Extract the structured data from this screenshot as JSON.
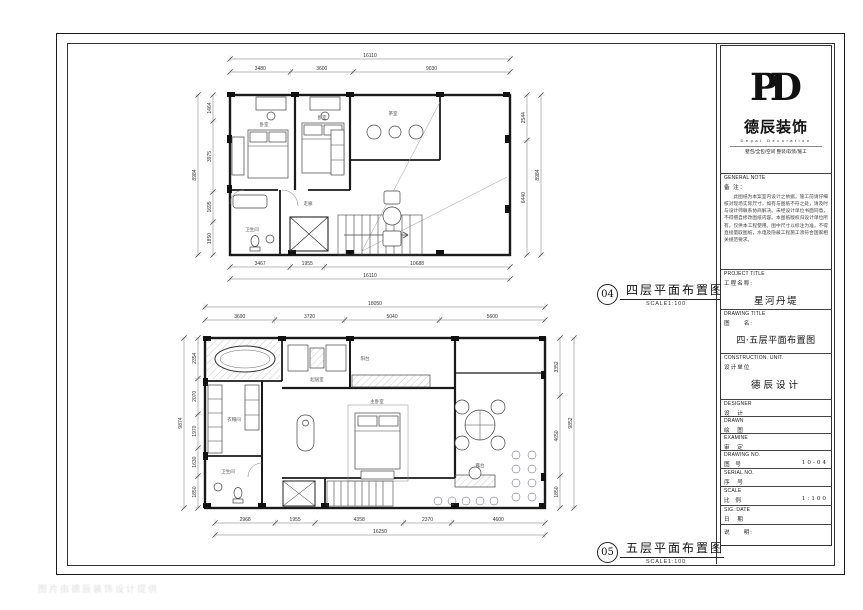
{
  "brand": {
    "logo_monogram": "PD",
    "company_cn": "德辰装饰",
    "company_en": "Depal Decoration",
    "services": "墅包/全包/空间 整装/软装/施工"
  },
  "general_note": {
    "label_en": "GENERAL NOTE",
    "label_cn": "备  注：",
    "body": "此图纸为本案室内设计之依据，施工前请仔细核对现场实际尺寸，如有与图纸不符之处，请及时与设计师联系协商解决。未经设计单位书面同意，不得擅自修改图纸内容。本图纸版权归设计单位所有，仅供本工程使用。图中尺寸以标注为准，不得直接量取图纸，水电及隐蔽工程施工须符合国家相关规范要求。"
  },
  "titleblock": {
    "project_title_en": "PROJECT TITLE",
    "project_title_cn": "工程名称:",
    "project_name": "星河丹堤",
    "drawing_title_en": "DRAWING TITLE",
    "drawing_title_cn": "图　　名:",
    "drawing_name": "四·五层平面布置图",
    "unit_en": "CONSTRUCTION. UNIT.",
    "unit_cn": "设计单位",
    "unit_name": "德辰设计",
    "designer_en": "DESIGNER",
    "designer_cn": "设　计",
    "drawn_en": "DRAWN",
    "drawn_cn": "绘　图",
    "examine_en": "EXAMINE",
    "examine_cn": "审　定",
    "drawing_no_en": "DRAWING NO.",
    "drawing_no_cn": "图　号",
    "drawing_no": "10-04",
    "serial_no_en": "SERIAL NO.",
    "serial_no_cn": "序　号",
    "scale_en": "SCALE",
    "scale_cn": "比　例",
    "scale": "1:100",
    "date_en": "SIG. DATE",
    "date_cn": "日　期",
    "remark_cn": "说　　明:"
  },
  "callouts": {
    "floor4": {
      "num": "04",
      "title": "四层平面布置图",
      "scale": "SCALE1:100"
    },
    "floor5": {
      "num": "05",
      "title": "五层平面布置图",
      "scale": "SCALE1:100"
    }
  },
  "plans": {
    "floor4": {
      "dims": {
        "top_total": [
          "16110"
        ],
        "top": [
          "3480",
          "3600",
          "9030"
        ],
        "bottom": [
          "3467",
          "1955",
          "10688"
        ],
        "bottom_total": [
          "16110"
        ],
        "left": [
          "1464",
          "3975",
          "1695",
          "1850"
        ],
        "left_total": [
          "8984"
        ],
        "right": [
          "2544",
          "6440"
        ],
        "right_total": [
          "8984"
        ]
      },
      "rooms": [
        "卧室",
        "卧室",
        "茶室",
        "走廊",
        "卫生间"
      ]
    },
    "floor5": {
      "dims": {
        "top_total": [
          "18050"
        ],
        "top": [
          "3690",
          "3720",
          "5040",
          "5600"
        ],
        "bottom": [
          "2968",
          "1955",
          "4358",
          "2370",
          "4600"
        ],
        "bottom_total": [
          "16250"
        ],
        "left": [
          "2354",
          "2070",
          "1970",
          "1630",
          "1850"
        ],
        "left_total": [
          "9874"
        ],
        "right": [
          "3352",
          "4650",
          "1850"
        ],
        "right_total": [
          "9852"
        ]
      },
      "rooms": [
        "主卧室",
        "起居室",
        "衣帽间",
        "卫生间",
        "露台",
        "阳台"
      ]
    }
  },
  "watermark": {
    "text": "图片由德辰装饰设计提供"
  },
  "colors": {
    "line": "#1a1a1a",
    "dim": "#555",
    "paper": "#ffffff"
  }
}
